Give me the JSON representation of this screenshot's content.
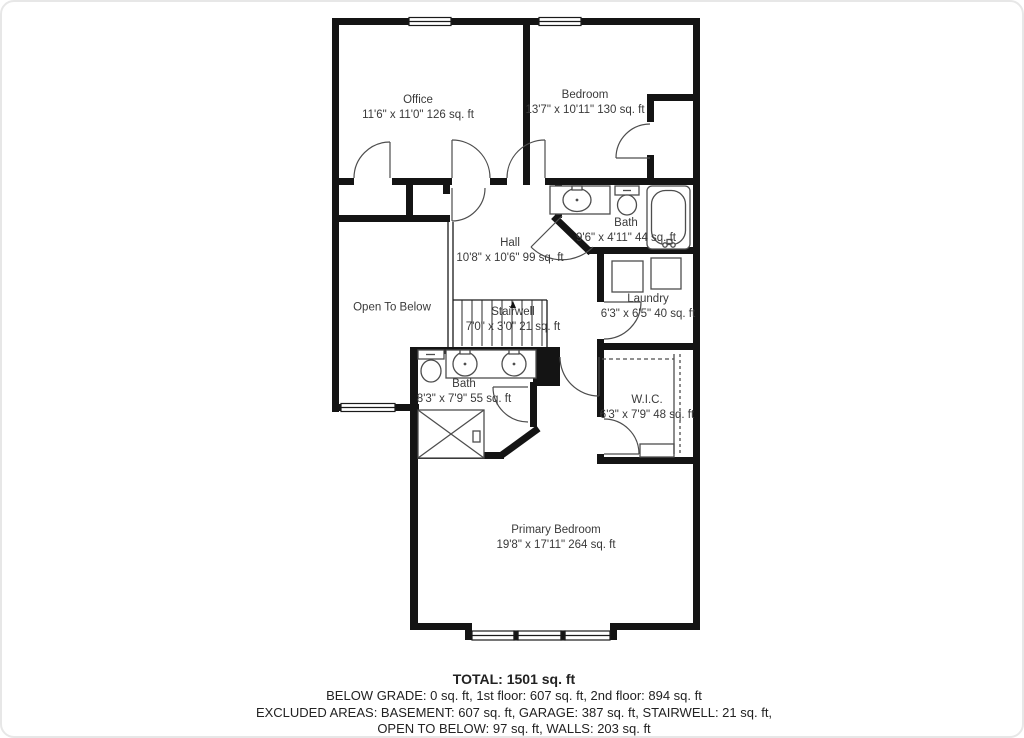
{
  "rooms": {
    "office": {
      "name": "Office",
      "dims": "11'6\" x 11'0\" 126 sq. ft"
    },
    "bedroom": {
      "name": "Bedroom",
      "dims": "13'7\" x 10'11\" 130 sq. ft"
    },
    "bath_upper": {
      "name": "Bath",
      "dims": "9'6\" x 4'11\" 44 sq. ft"
    },
    "hall": {
      "name": "Hall",
      "dims": "10'8\" x 10'6\" 99 sq. ft"
    },
    "laundry": {
      "name": "Laundry",
      "dims": "6'3\" x 6'5\" 40 sq. ft"
    },
    "open_to_below": {
      "name": "Open To Below"
    },
    "stairwell": {
      "name": "Stairwell",
      "dims": "7'0\" x 3'0\" 21 sq. ft"
    },
    "bath_lower": {
      "name": "Bath",
      "dims": "8'3\" x 7'9\" 55 sq. ft"
    },
    "wic": {
      "name": "W.I.C.",
      "dims": "6'3\" x 7'9\" 48 sq. ft"
    },
    "primary_bedroom": {
      "name": "Primary Bedroom",
      "dims": "19'8\" x 17'11\" 264 sq. ft"
    }
  },
  "footer": {
    "total": "TOTAL: 1501 sq. ft",
    "line2": "BELOW GRADE: 0 sq. ft, 1st floor: 607 sq. ft, 2nd floor: 894 sq. ft",
    "line3": "EXCLUDED AREAS: BASEMENT: 607 sq. ft, GARAGE: 387 sq. ft, STAIRWELL: 21 sq. ft,",
    "line4": "OPEN TO BELOW: 97 sq. ft, WALLS: 203 sq. ft"
  },
  "colors": {
    "wall": "#141414",
    "fixture_outline": "#4d4d4d",
    "label_text": "#3a3a3a",
    "footer_text": "#222222",
    "card_border": "#e7e7e7"
  }
}
